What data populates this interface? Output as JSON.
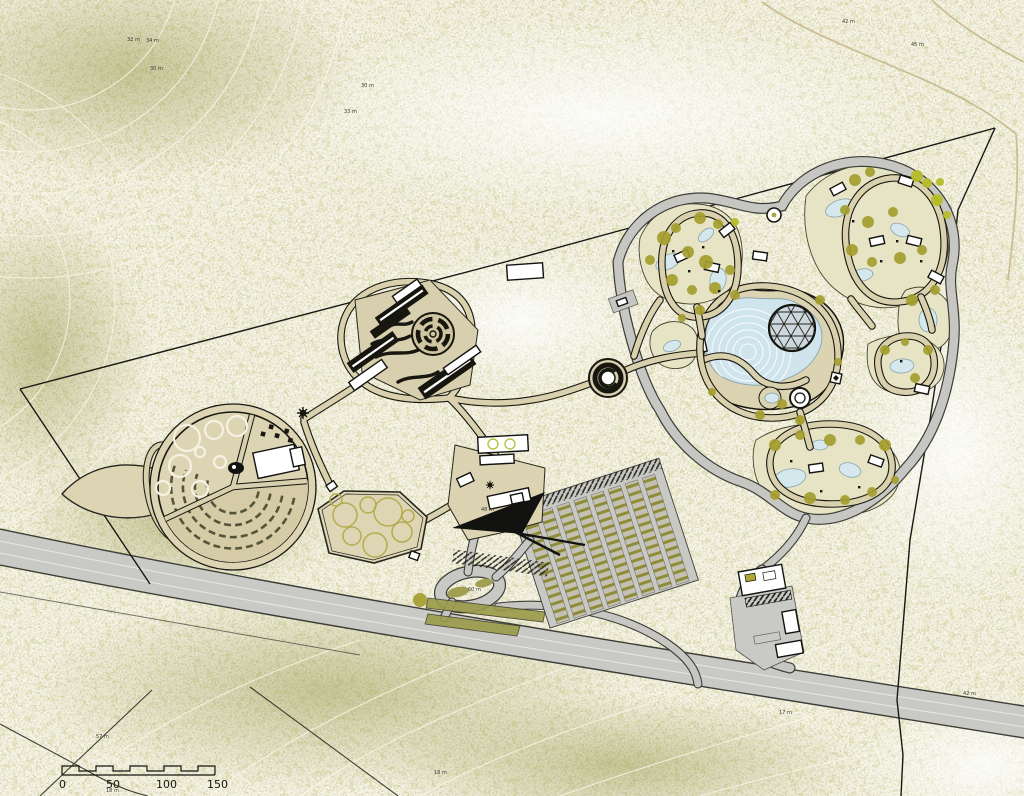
{
  "plan": {
    "type": "landscape-site-master-plan",
    "colors": {
      "paper": "#f1eedd",
      "vegetation_speckle": "#8d8d42",
      "vegetation_clump": "#9aa04a",
      "path_tan": "#d9d0ae",
      "road_gray": "#c9c9c6",
      "water_blue": "#d5e8ee",
      "lake_blue": "#cfe4ec",
      "building_white": "#ffffff",
      "linework_black": "#17170f",
      "tree_olive": "#a49d2f",
      "tree_lime": "#b6bd28",
      "contour_cream": "#faf7e8"
    }
  },
  "scale_bar": {
    "labels": [
      "0",
      "50",
      "100",
      "150"
    ]
  },
  "contour_labels": [
    {
      "text": "32 m",
      "x": 127,
      "y": 41
    },
    {
      "text": "34 m",
      "x": 146,
      "y": 42
    },
    {
      "text": "30 m",
      "x": 150,
      "y": 70
    },
    {
      "text": "30 m",
      "x": 361,
      "y": 87
    },
    {
      "text": "33 m",
      "x": 344,
      "y": 113
    },
    {
      "text": "45 m",
      "x": 911,
      "y": 46
    },
    {
      "text": "42 m",
      "x": 842,
      "y": 23
    },
    {
      "text": "48 m",
      "x": 481,
      "y": 511
    },
    {
      "text": "60 m",
      "x": 468,
      "y": 591
    },
    {
      "text": "42 m",
      "x": 963,
      "y": 695
    },
    {
      "text": "17 m",
      "x": 779,
      "y": 714
    },
    {
      "text": "57 m",
      "x": 96,
      "y": 738
    },
    {
      "text": "18 m",
      "x": 106,
      "y": 792
    },
    {
      "text": "18 m",
      "x": 434,
      "y": 774
    }
  ]
}
